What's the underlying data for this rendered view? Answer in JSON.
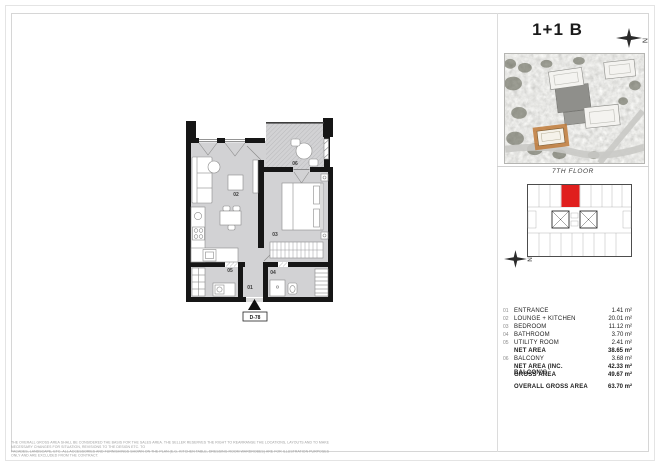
{
  "page": {
    "title": "1+1 B",
    "floor_label": "7TH FLOOR"
  },
  "compass": {
    "n": "N"
  },
  "floor_plan": {
    "labels": [
      "01",
      "02",
      "03",
      "04",
      "05",
      "06"
    ],
    "unit_code": "D-78"
  },
  "area_table": {
    "rows": [
      {
        "num": "01",
        "label": "ENTRANCE",
        "value": "1.41 m²"
      },
      {
        "num": "02",
        "label": "LOUNGE + KITCHEN",
        "value": "20.01 m²"
      },
      {
        "num": "03",
        "label": "BEDROOM",
        "value": "11.12 m²"
      },
      {
        "num": "04",
        "label": "BATHROOM",
        "value": "3.70 m²"
      },
      {
        "num": "05",
        "label": "UTILITY ROOM",
        "value": "2.41 m²"
      },
      {
        "num": "",
        "label": "NET AREA",
        "value": "38.65 m²"
      },
      {
        "num": "06",
        "label": "BALCONY",
        "value": "3.68 m²"
      },
      {
        "num": "",
        "label": "NET AREA (INC. BALCONY)",
        "value": "42.33 m²"
      },
      {
        "num": "",
        "label": "GROSS AREA",
        "value": "49.67 m²"
      },
      {
        "num": "",
        "label": "OVERALL GROSS AREA",
        "value": "63.70 m²"
      }
    ]
  },
  "disclaimer": {
    "line1": "THE OVERALL GROSS AREA SHALL BE CONSIDERED THE BASIS FOR THE SALES AREA. THE SELLER RESERVES THE RIGHT TO REARRANGE THE LOCATIONS, LAYOUTS AND TO MAKE NECESSARY CHANGES FOR SITUATION, REVISIONS TO THE DESIGN ETC. TO",
    "line2": "FACADES, LANDSCAPE, ETC. ALL ACCESSORIES AND FURNISHINGS SHOWN ON THE PLAN (E.G. KITCHEN TABLE, DRESSING ROOM WARDROBES) ARE FOR ILLUSTRATION PURPOSES ONLY AND ARE EXCLUDED FROM THE CONTRACT."
  },
  "colors": {
    "highlight_red": "#e01f1d",
    "highlight_orange": "#c07a38",
    "wall_black": "#161616",
    "floor_gray": "#d2d2d4"
  }
}
